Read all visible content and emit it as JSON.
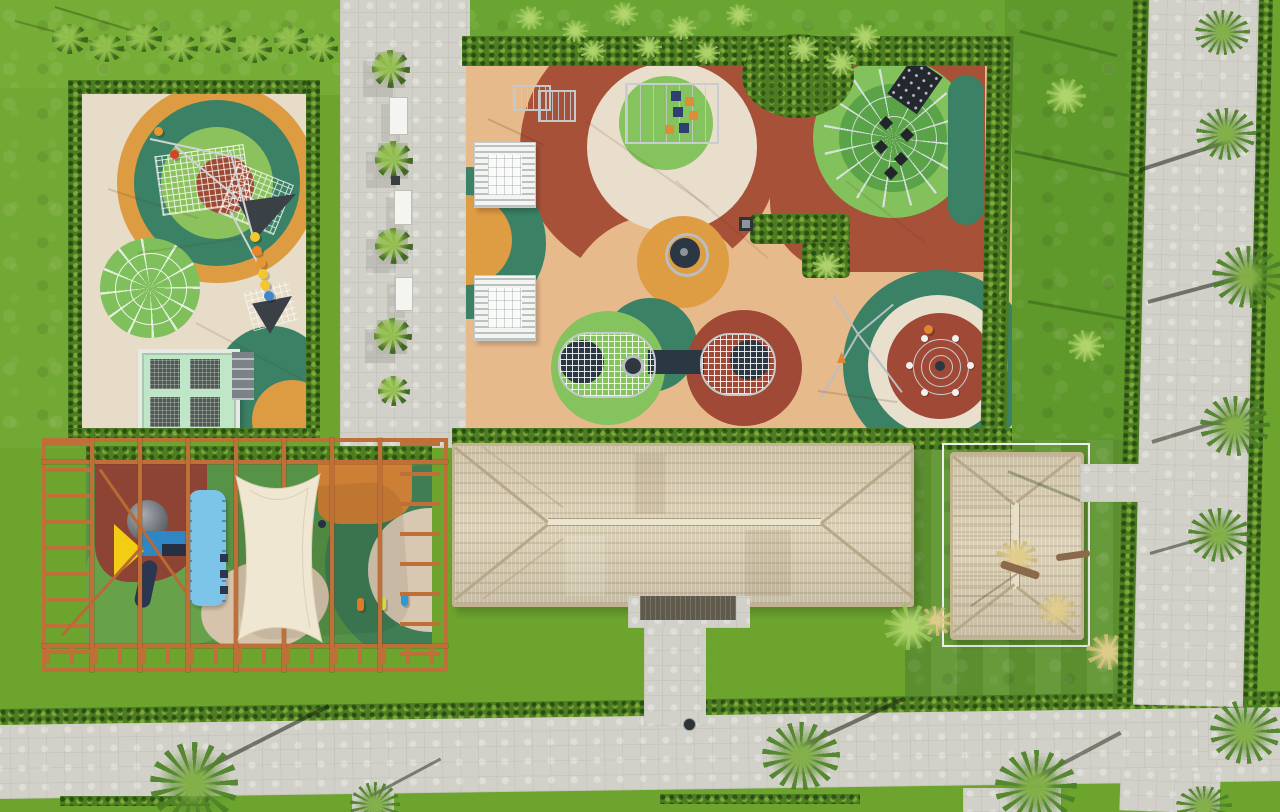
{
  "scene": {
    "type": "aerial-drone-photo",
    "title": "Aerial view of resort playground complex",
    "description": "Top-down drone photograph of a landscaped resort play area: two rubber-surfaced playgrounds with concentric circle patterns and climbing equipment, a wooden pergola toddler playground with shade sails, two thatched-roof pavilions, paved walkways, hedges, lawns and palm trees.",
    "areas": {
      "left_playground": "Cream rubber playground with orange/teal/green target circles, rope nets, spider-web climber, ball line and mini trampoline",
      "main_playground": "Large peach rubber playground with terracotta, cream, green and orange circles, climbing cube, geodesic dome, tunnel nets, spinner and carousel",
      "toddler_pergola": "Timber pergola over toddler play area with blue play ship, yellow flag, slide, sky-blue canopy and cream shade sail",
      "beach_house_large": "Long thatched-roof pavilion with central entrance walkway",
      "beach_house_small": "Small thatched-roof pavilion inside white construction frame",
      "plaza": "Paved plaza strip with planters and white benches",
      "promenade": "Paved promenade crossing the bottom with palm trees",
      "right_walkway": "Vertical paved walkway lined with hedges and palms",
      "lawns": "Manicured lawns with palm shadows and grass tufts"
    },
    "palette": {
      "grass": "#6ca42e",
      "hedge": "#4c7d22",
      "paving": "#d2d1c9",
      "rubber_peach": "#e7ba8c",
      "rubber_cream": "#e6dcc8",
      "terracotta": "#a75138",
      "dark_red": "#9c4a33",
      "teal_green": "#3a8165",
      "light_green": "#85c35f",
      "orange": "#de9c43",
      "thatch": "#d8cdb2",
      "pergola_wood": "#bf7038",
      "shade_sail": "#efe7d2",
      "sky_blue": "#7cc4e8",
      "navy": "#2c3744",
      "yellow": "#f2cd13",
      "mint": "#bfe7c7"
    },
    "objects": {
      "balls": [
        "yellow",
        "orange",
        "orange",
        "yellow",
        "yellow",
        "blue",
        "red",
        "orange"
      ],
      "planter_count": 4,
      "bench_count": 3,
      "palm_count": 14
    }
  }
}
